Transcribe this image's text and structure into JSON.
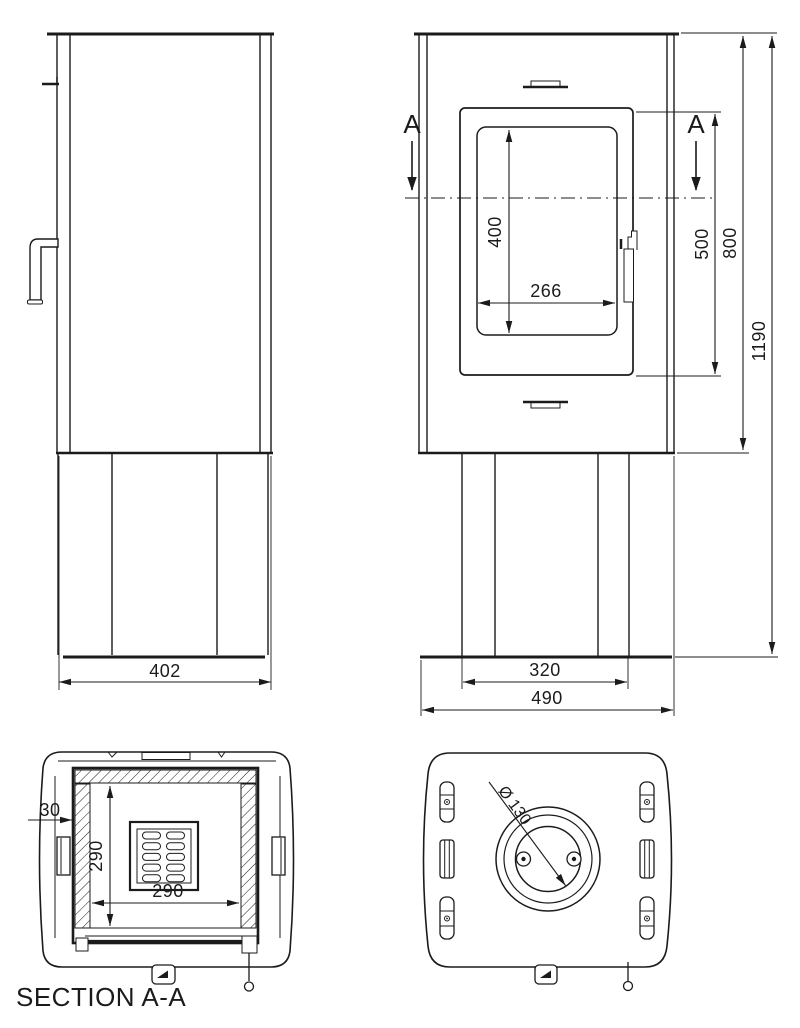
{
  "view_labels": {
    "section_title": "SECTION A-A",
    "section_marker": "A"
  },
  "dims": {
    "body_depth": "402",
    "glass_height": "400",
    "glass_width": "266",
    "door_height": "500",
    "body_height": "800",
    "total_height": "1190",
    "pedestal_width": "320",
    "body_width": "490",
    "liner_gap": "30",
    "firebox_depth": "290",
    "firebox_width": "290",
    "flue_diameter": "Ø 130"
  },
  "colors": {
    "line": "#1b1b1b",
    "background": "#ffffff"
  }
}
